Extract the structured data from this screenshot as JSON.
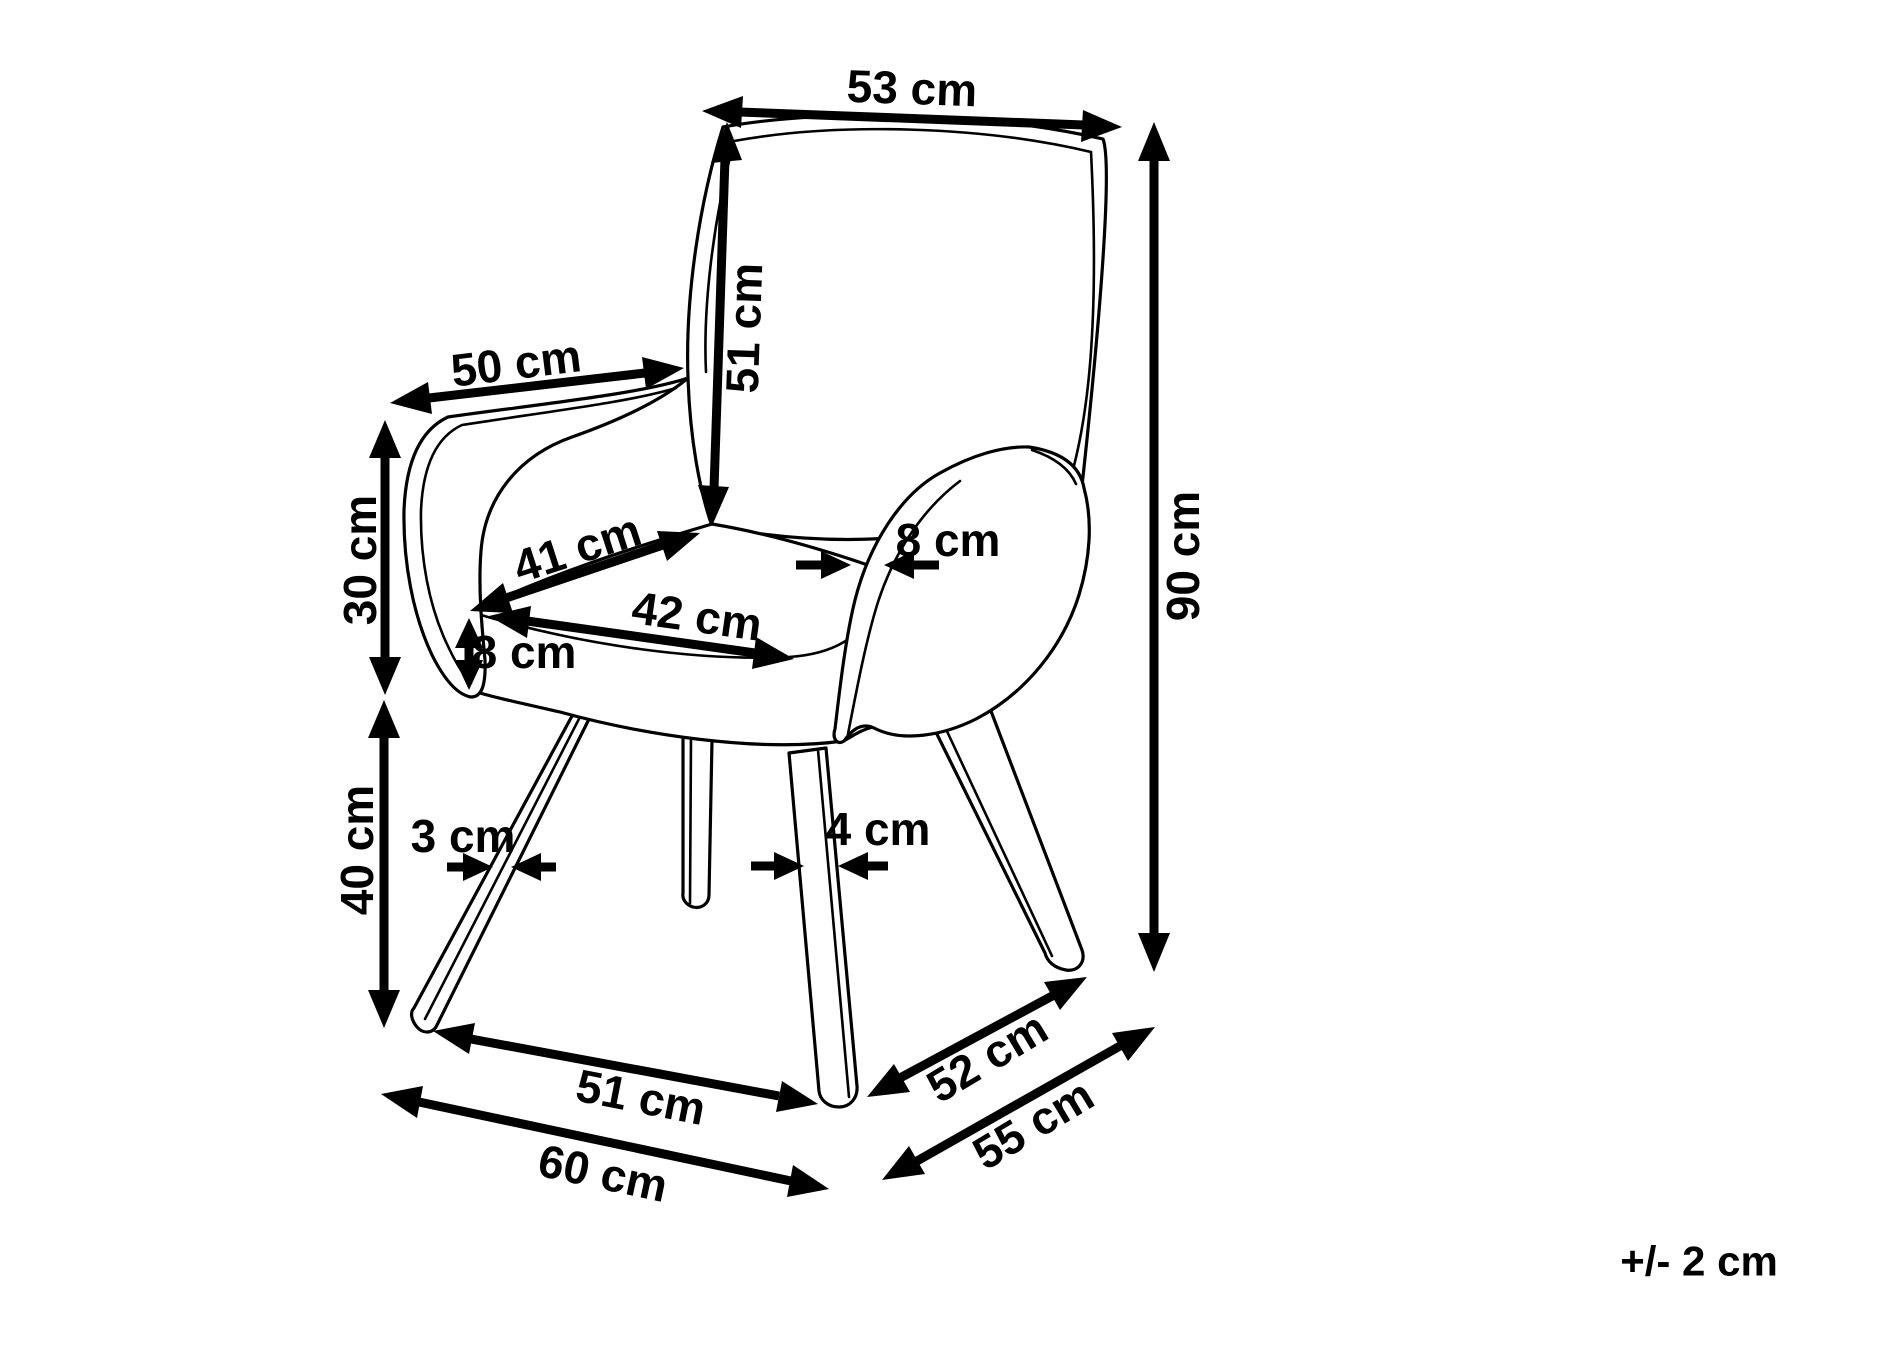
{
  "diagram": {
    "subject": "armchair-dimension-drawing",
    "unit": "cm",
    "ink_color": "#000000",
    "background_color": "#ffffff",
    "tolerance_note": "+/- 2 cm",
    "labels": {
      "backrest_top_width": "53 cm",
      "backrest_height": "51 cm",
      "armrest_length": "50 cm",
      "armrest_side_height": "30 cm",
      "seat_depth": "41 cm",
      "seat_width": "42 cm",
      "seat_cushion_thickness": "8 cm",
      "armrest_thickness": "8 cm",
      "left_leg_thickness": "3 cm",
      "right_leg_thickness": "4 cm",
      "leg_height": "40 cm",
      "total_height": "90 cm",
      "front_base_width": "51 cm",
      "max_base_width": "60 cm",
      "base_depth": "52 cm",
      "max_base_depth": "55 cm"
    }
  }
}
